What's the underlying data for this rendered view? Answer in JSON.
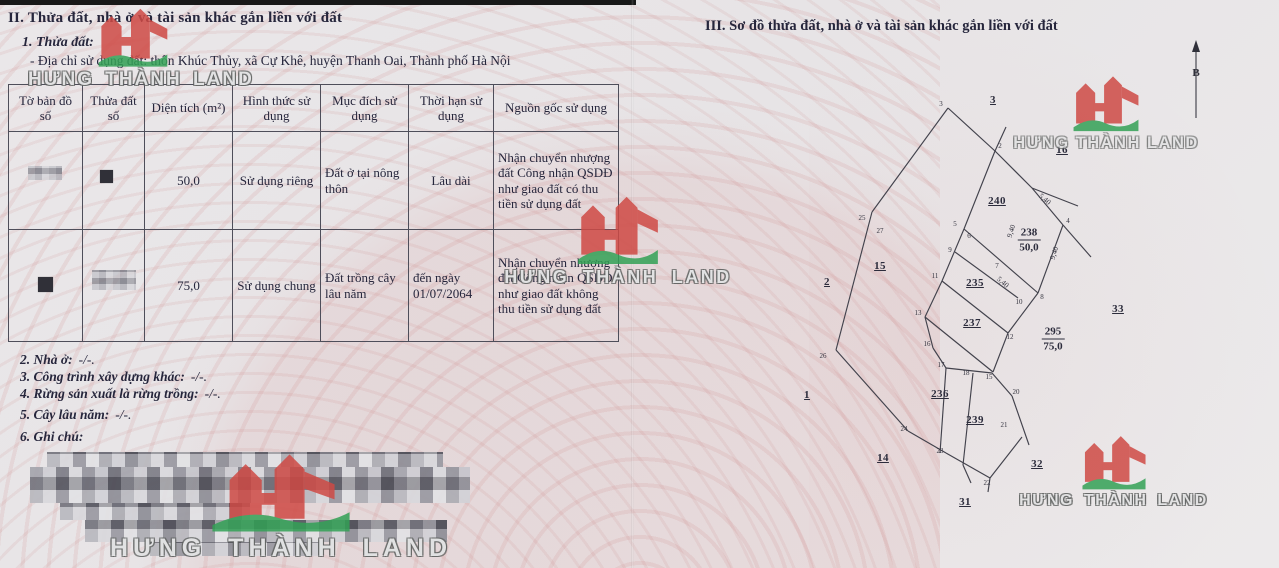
{
  "document": {
    "section2": {
      "title": "II. Thửa đất, nhà ở và tài sản khác gắn liền với đất",
      "subsection": "1. Thửa đất:",
      "address": "- Địa chỉ sử dụng đất:  thôn Khúc Thủy, xã Cự Khê, huyện Thanh Oai, Thành phố Hà Nội",
      "items": [
        {
          "label": "2. Nhà ở:",
          "value": "-/-."
        },
        {
          "label": "3. Công trình xây dựng khác:",
          "value": "-/-."
        },
        {
          "label": "4. Rừng sản xuất là rừng trồng:",
          "value": "-/-."
        },
        {
          "label": "5. Cây lâu năm:",
          "value": "-/-."
        },
        {
          "label": "6. Ghi chú:",
          "value": ""
        }
      ]
    },
    "section3": {
      "title": "III. Sơ đồ thửa đất, nhà ở và tài sản khác gắn liền với đất",
      "north_arrow_label": "B"
    }
  },
  "table": {
    "headers": [
      "Tờ bản đồ số",
      "Thửa đất số",
      "Diện tích (m²)",
      "Hình thức sử dụng",
      "Mục đích sử dụng",
      "Thời hạn sử dụng",
      "Nguồn gốc sử dụng"
    ],
    "rows": [
      [
        "",
        "",
        "50,0",
        "Sử dụng riêng",
        "Đất ở tại nông thôn",
        "Lâu dài",
        "Nhận chuyển nhượng đất Công nhận QSDĐ như giao đất có thu tiền sử dụng đất"
      ],
      [
        "",
        "",
        "75,0",
        "Sử dụng chung",
        "Đất trồng cây lâu năm",
        "đến ngày 01/07/2064",
        "Nhận chuyển nhượng đất Công nhận QSDĐ như giao đất không thu tiền sử dụng đất"
      ]
    ]
  },
  "watermark": {
    "text": "HƯNG THÀNH LAND",
    "logo_red": "#cf4a45",
    "logo_green": "#33a156"
  },
  "map": {
    "segments": [
      [
        948,
        108,
        872,
        212
      ],
      [
        872,
        212,
        836,
        350
      ],
      [
        836,
        350,
        908,
        431
      ],
      [
        908,
        431,
        946,
        453
      ],
      [
        946,
        453,
        990,
        478
      ],
      [
        948,
        108,
        995,
        151
      ],
      [
        995,
        151,
        1006,
        127
      ],
      [
        995,
        151,
        964,
        229
      ],
      [
        964,
        229,
        942,
        281
      ],
      [
        942,
        281,
        925,
        317
      ],
      [
        925,
        317,
        933,
        348
      ],
      [
        933,
        348,
        946,
        368
      ],
      [
        995,
        151,
        1032,
        188
      ],
      [
        1032,
        188,
        1063,
        225
      ],
      [
        1032,
        188,
        1078,
        206
      ],
      [
        1063,
        225,
        1091,
        257
      ],
      [
        1063,
        225,
        1038,
        293
      ],
      [
        1038,
        293,
        1008,
        333
      ],
      [
        1008,
        333,
        993,
        372
      ],
      [
        964,
        229,
        1038,
        293
      ],
      [
        955,
        252,
        1018,
        298
      ],
      [
        942,
        281,
        1008,
        333
      ],
      [
        925,
        317,
        993,
        372
      ],
      [
        946,
        368,
        992,
        373
      ],
      [
        992,
        373,
        1012,
        396
      ],
      [
        1012,
        396,
        1029,
        445
      ],
      [
        946,
        368,
        940,
        453
      ],
      [
        973,
        373,
        963,
        465
      ],
      [
        963,
        465,
        971,
        483
      ],
      [
        990,
        478,
        1022,
        437
      ],
      [
        990,
        478,
        988,
        492
      ]
    ],
    "parcel_labels": [
      {
        "t": "3",
        "x": 993,
        "y": 100
      },
      {
        "t": "16",
        "x": 1062,
        "y": 150
      },
      {
        "t": "240",
        "x": 997,
        "y": 201
      },
      {
        "t": "2",
        "x": 827,
        "y": 282
      },
      {
        "t": "15",
        "x": 880,
        "y": 266
      },
      {
        "t": "235",
        "x": 975,
        "y": 283
      },
      {
        "t": "237",
        "x": 972,
        "y": 323
      },
      {
        "t": "33",
        "x": 1118,
        "y": 309
      },
      {
        "t": "1",
        "x": 807,
        "y": 395
      },
      {
        "t": "236",
        "x": 940,
        "y": 394
      },
      {
        "t": "239",
        "x": 975,
        "y": 420
      },
      {
        "t": "14",
        "x": 883,
        "y": 458
      },
      {
        "t": "32",
        "x": 1037,
        "y": 464
      },
      {
        "t": "31",
        "x": 965,
        "y": 502
      }
    ],
    "fraction_labels": [
      {
        "num": "238",
        "den": "50,0",
        "x": 1029,
        "y": 240
      },
      {
        "num": "295",
        "den": "75,0",
        "x": 1053,
        "y": 339
      }
    ],
    "vertex_labels": [
      {
        "t": "3",
        "x": 941,
        "y": 104
      },
      {
        "t": "2",
        "x": 1000,
        "y": 146
      },
      {
        "t": "5",
        "x": 955,
        "y": 224
      },
      {
        "t": "6",
        "x": 969,
        "y": 236
      },
      {
        "t": "9",
        "x": 950,
        "y": 250
      },
      {
        "t": "7",
        "x": 997,
        "y": 266
      },
      {
        "t": "11",
        "x": 935,
        "y": 276
      },
      {
        "t": "10",
        "x": 1019,
        "y": 302
      },
      {
        "t": "13",
        "x": 918,
        "y": 313
      },
      {
        "t": "12",
        "x": 1010,
        "y": 337
      },
      {
        "t": "16",
        "x": 927,
        "y": 344
      },
      {
        "t": "17",
        "x": 941,
        "y": 365
      },
      {
        "t": "18",
        "x": 966,
        "y": 373
      },
      {
        "t": "15",
        "x": 989,
        "y": 377
      },
      {
        "t": "20",
        "x": 1016,
        "y": 392
      },
      {
        "t": "21",
        "x": 1004,
        "y": 425
      },
      {
        "t": "25",
        "x": 862,
        "y": 218
      },
      {
        "t": "27",
        "x": 880,
        "y": 231
      },
      {
        "t": "26",
        "x": 823,
        "y": 356
      },
      {
        "t": "24",
        "x": 904,
        "y": 429
      },
      {
        "t": "23",
        "x": 940,
        "y": 451
      },
      {
        "t": "22",
        "x": 987,
        "y": 483
      },
      {
        "t": "4",
        "x": 1068,
        "y": 221
      },
      {
        "t": "8",
        "x": 1042,
        "y": 297
      }
    ],
    "edge_labels": [
      {
        "t": "5,40",
        "x": 1045,
        "y": 199,
        "r": 40
      },
      {
        "t": "9,40",
        "x": 1054,
        "y": 253,
        "r": -72
      },
      {
        "t": "9,40",
        "x": 1011,
        "y": 231,
        "r": -72
      },
      {
        "t": "5,40",
        "x": 1003,
        "y": 282,
        "r": 40
      }
    ]
  }
}
